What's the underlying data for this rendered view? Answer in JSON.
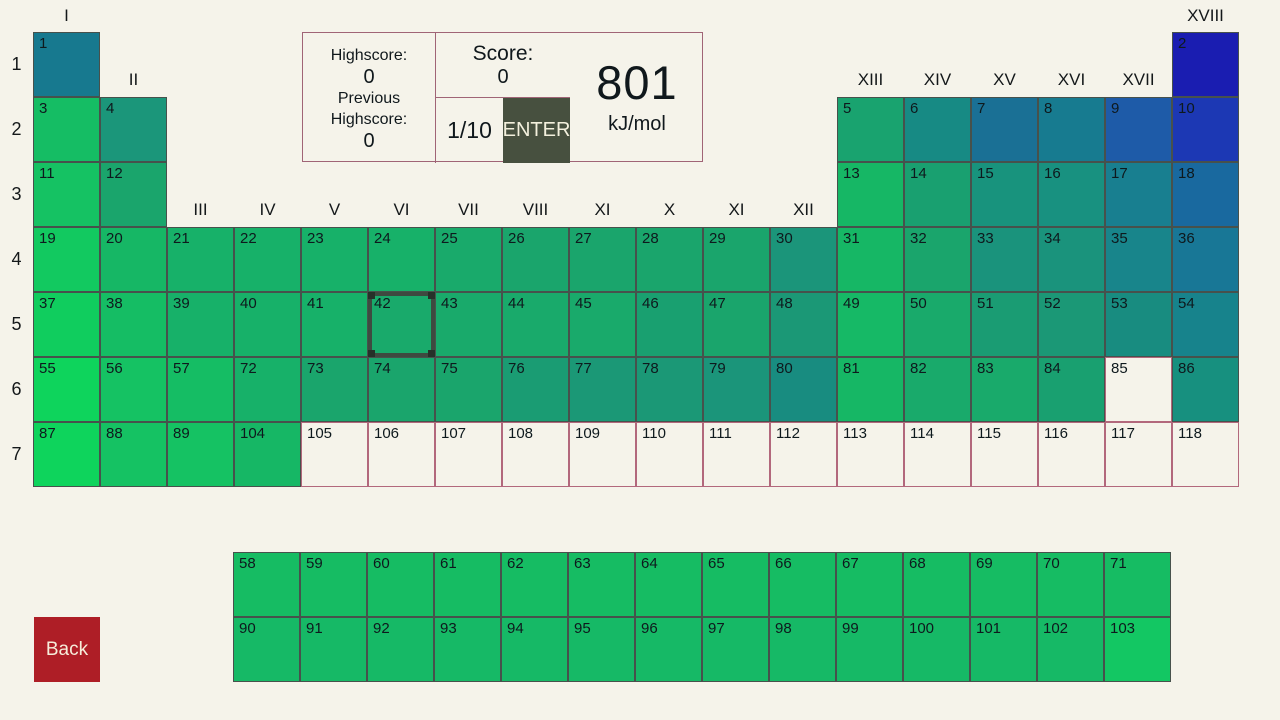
{
  "scoreboard": {
    "highscore_label": "Highscore:",
    "highscore_value": "0",
    "previous_highscore_label": "Previous Highscore:",
    "previous_highscore_value": "0",
    "score_label": "Score:",
    "score_value": "0",
    "round_counter": "1/10",
    "enter_label": "ENTER",
    "target_value": "801",
    "target_unit": "kJ/mol"
  },
  "back_button": {
    "label": "Back",
    "color": "#ae1e26"
  },
  "colors": {
    "background": "#f5f3ea",
    "panel_border": "#a06476",
    "cell_border": "#47514c",
    "empty_cell_border": "#b2687c",
    "selection_border": "#3e4a40",
    "enter_button": "#47503f"
  },
  "periodic_table": {
    "selected_cell": 42,
    "period_labels": [
      "1",
      "2",
      "3",
      "4",
      "5",
      "6",
      "7"
    ],
    "group_labels": [
      {
        "label": "I",
        "col": 1,
        "tier": "top"
      },
      {
        "label": "XVIII",
        "col": 18,
        "tier": "top"
      },
      {
        "label": "II",
        "col": 2,
        "tier": "mid"
      },
      {
        "label": "XIII",
        "col": 13,
        "tier": "mid"
      },
      {
        "label": "XIV",
        "col": 14,
        "tier": "mid"
      },
      {
        "label": "XV",
        "col": 15,
        "tier": "mid"
      },
      {
        "label": "XVI",
        "col": 16,
        "tier": "mid"
      },
      {
        "label": "XVII",
        "col": 17,
        "tier": "mid"
      },
      {
        "label": "III",
        "col": 3,
        "tier": "low"
      },
      {
        "label": "IV",
        "col": 4,
        "tier": "low"
      },
      {
        "label": "V",
        "col": 5,
        "tier": "low"
      },
      {
        "label": "VI",
        "col": 6,
        "tier": "low"
      },
      {
        "label": "VII",
        "col": 7,
        "tier": "low"
      },
      {
        "label": "VIII",
        "col": 8,
        "tier": "low"
      },
      {
        "label": "XI",
        "col": 9,
        "tier": "low"
      },
      {
        "label": "X",
        "col": 10,
        "tier": "low"
      },
      {
        "label": "XI",
        "col": 11,
        "tier": "low"
      },
      {
        "label": "XII",
        "col": 12,
        "tier": "low"
      }
    ],
    "cells": [
      [
        1,
        1,
        1,
        "#17798f"
      ],
      [
        2,
        1,
        18,
        "#1a1db1"
      ],
      [
        3,
        2,
        1,
        "#15bd64"
      ],
      [
        4,
        2,
        2,
        "#1b967a"
      ],
      [
        5,
        2,
        13,
        "#19a36f"
      ],
      [
        6,
        2,
        14,
        "#178a84"
      ],
      [
        7,
        2,
        15,
        "#1a7095"
      ],
      [
        8,
        2,
        16,
        "#177b90"
      ],
      [
        9,
        2,
        17,
        "#1e5ba8"
      ],
      [
        10,
        2,
        18,
        "#1c38b4"
      ],
      [
        11,
        3,
        1,
        "#15c263"
      ],
      [
        12,
        3,
        2,
        "#1aa56c"
      ],
      [
        13,
        3,
        13,
        "#16b765"
      ],
      [
        14,
        3,
        14,
        "#19a070"
      ],
      [
        15,
        3,
        15,
        "#18937d"
      ],
      [
        16,
        3,
        16,
        "#189180"
      ],
      [
        17,
        3,
        17,
        "#187f90"
      ],
      [
        18,
        3,
        18,
        "#19699f"
      ],
      [
        19,
        4,
        1,
        "#12c960"
      ],
      [
        20,
        4,
        2,
        "#16b765"
      ],
      [
        21,
        4,
        3,
        "#17b169"
      ],
      [
        22,
        4,
        4,
        "#17b169"
      ],
      [
        23,
        4,
        5,
        "#17b169"
      ],
      [
        24,
        4,
        6,
        "#17b169"
      ],
      [
        25,
        4,
        7,
        "#19aa6b"
      ],
      [
        26,
        4,
        8,
        "#1aa56c"
      ],
      [
        27,
        4,
        9,
        "#1aa56c"
      ],
      [
        28,
        4,
        10,
        "#1aa56c"
      ],
      [
        29,
        4,
        11,
        "#1aa56c"
      ],
      [
        30,
        4,
        12,
        "#1b957a"
      ],
      [
        31,
        4,
        13,
        "#16b765"
      ],
      [
        32,
        4,
        14,
        "#1aa56c"
      ],
      [
        33,
        4,
        15,
        "#1a937c"
      ],
      [
        34,
        4,
        16,
        "#1a937c"
      ],
      [
        35,
        4,
        17,
        "#18858b"
      ],
      [
        36,
        4,
        18,
        "#187796"
      ],
      [
        37,
        5,
        1,
        "#10cd5e"
      ],
      [
        38,
        5,
        2,
        "#15bd64"
      ],
      [
        39,
        5,
        3,
        "#17b169"
      ],
      [
        40,
        5,
        4,
        "#17b169"
      ],
      [
        41,
        5,
        5,
        "#17b169"
      ],
      [
        42,
        5,
        6,
        "#19aa6b"
      ],
      [
        43,
        5,
        7,
        "#19aa6b"
      ],
      [
        44,
        5,
        8,
        "#19aa6b"
      ],
      [
        45,
        5,
        9,
        "#19aa6b"
      ],
      [
        46,
        5,
        10,
        "#19a070"
      ],
      [
        47,
        5,
        11,
        "#1aa56c"
      ],
      [
        48,
        5,
        12,
        "#1b9876"
      ],
      [
        49,
        5,
        13,
        "#16b966"
      ],
      [
        50,
        5,
        14,
        "#19aa6b"
      ],
      [
        51,
        5,
        15,
        "#1a9c73"
      ],
      [
        52,
        5,
        16,
        "#1b9876"
      ],
      [
        53,
        5,
        17,
        "#188c80"
      ],
      [
        54,
        5,
        18,
        "#17838c"
      ],
      [
        55,
        6,
        1,
        "#0ed45c"
      ],
      [
        56,
        6,
        2,
        "#15c263"
      ],
      [
        57,
        6,
        3,
        "#15bd64"
      ],
      [
        72,
        6,
        4,
        "#17b169"
      ],
      [
        73,
        6,
        5,
        "#1aa56c"
      ],
      [
        74,
        6,
        6,
        "#1aa56c"
      ],
      [
        75,
        6,
        7,
        "#1aa56c"
      ],
      [
        76,
        6,
        8,
        "#1a9c73"
      ],
      [
        77,
        6,
        9,
        "#1b9876"
      ],
      [
        78,
        6,
        10,
        "#1b9876"
      ],
      [
        79,
        6,
        11,
        "#1b957a"
      ],
      [
        80,
        6,
        12,
        "#188c80"
      ],
      [
        81,
        6,
        13,
        "#16b765"
      ],
      [
        82,
        6,
        14,
        "#19aa6b"
      ],
      [
        83,
        6,
        15,
        "#19aa6b"
      ],
      [
        84,
        6,
        16,
        "#19a070"
      ],
      [
        85,
        6,
        17,
        null
      ],
      [
        86,
        6,
        18,
        "#17907f"
      ],
      [
        87,
        7,
        1,
        "#0ed45c"
      ],
      [
        88,
        7,
        2,
        "#15c263"
      ],
      [
        89,
        7,
        3,
        "#15c263"
      ],
      [
        104,
        7,
        4,
        "#16b765"
      ],
      [
        105,
        7,
        5,
        null
      ],
      [
        106,
        7,
        6,
        null
      ],
      [
        107,
        7,
        7,
        null
      ],
      [
        108,
        7,
        8,
        null
      ],
      [
        109,
        7,
        9,
        null
      ],
      [
        110,
        7,
        10,
        null
      ],
      [
        111,
        7,
        11,
        null
      ],
      [
        112,
        7,
        12,
        null
      ],
      [
        113,
        7,
        13,
        null
      ],
      [
        114,
        7,
        14,
        null
      ],
      [
        115,
        7,
        15,
        null
      ],
      [
        116,
        7,
        16,
        null
      ],
      [
        117,
        7,
        17,
        null
      ],
      [
        118,
        7,
        18,
        null
      ]
    ],
    "f_block_cells": [
      [
        58,
        1,
        1,
        "#16bc63"
      ],
      [
        59,
        1,
        2,
        "#16bc63"
      ],
      [
        60,
        1,
        3,
        "#16bc63"
      ],
      [
        61,
        1,
        4,
        "#16bc63"
      ],
      [
        62,
        1,
        5,
        "#16bc63"
      ],
      [
        63,
        1,
        6,
        "#16bc63"
      ],
      [
        64,
        1,
        7,
        "#16bc63"
      ],
      [
        65,
        1,
        8,
        "#16bc63"
      ],
      [
        66,
        1,
        9,
        "#16bc63"
      ],
      [
        67,
        1,
        10,
        "#16bc63"
      ],
      [
        68,
        1,
        11,
        "#16bc63"
      ],
      [
        69,
        1,
        12,
        "#16bc63"
      ],
      [
        70,
        1,
        13,
        "#16bc63"
      ],
      [
        71,
        1,
        14,
        "#16bc63"
      ],
      [
        90,
        2,
        1,
        "#16b966"
      ],
      [
        91,
        2,
        2,
        "#16b966"
      ],
      [
        92,
        2,
        3,
        "#16b966"
      ],
      [
        93,
        2,
        4,
        "#16b966"
      ],
      [
        94,
        2,
        5,
        "#16b966"
      ],
      [
        95,
        2,
        6,
        "#16b966"
      ],
      [
        96,
        2,
        7,
        "#16b966"
      ],
      [
        97,
        2,
        8,
        "#16b966"
      ],
      [
        98,
        2,
        9,
        "#16b966"
      ],
      [
        99,
        2,
        10,
        "#16b966"
      ],
      [
        100,
        2,
        11,
        "#16b966"
      ],
      [
        101,
        2,
        12,
        "#16b966"
      ],
      [
        102,
        2,
        13,
        "#16b966"
      ],
      [
        103,
        2,
        14,
        "#13c763"
      ]
    ]
  }
}
